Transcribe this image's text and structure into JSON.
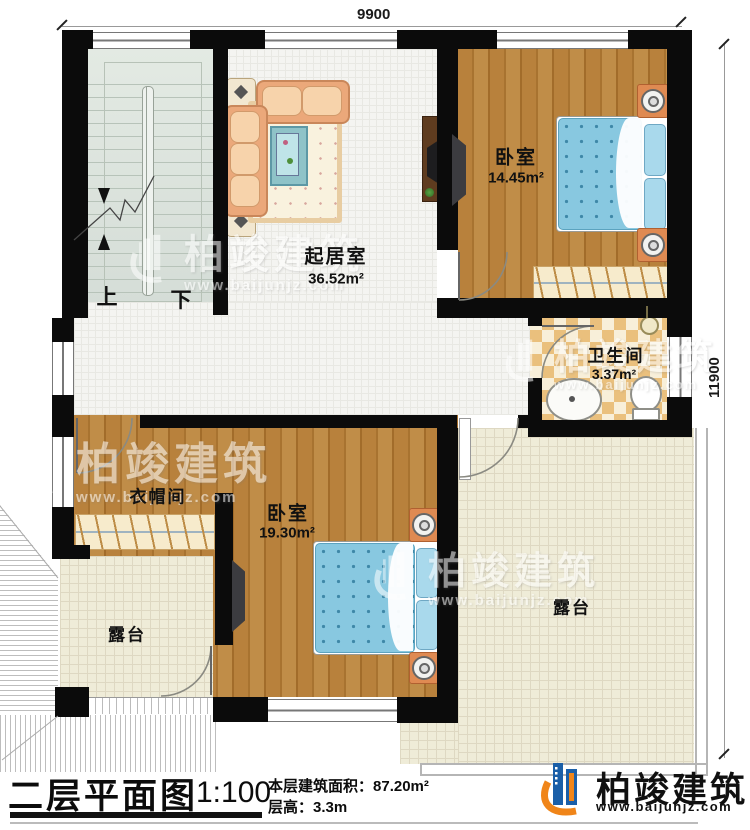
{
  "title_block": {
    "plan_title": "二层平面图",
    "scale": "1:100",
    "stats": [
      {
        "label": "本层建筑面积：",
        "value": "87.20m²"
      },
      {
        "label": "层高：",
        "value": "3.3m"
      }
    ]
  },
  "dimensions": {
    "top_width": "9900",
    "right_height": "11900"
  },
  "rooms": {
    "living": {
      "name": "起居室",
      "area": "36.52m²"
    },
    "bedroom_top": {
      "name": "卧室",
      "area": "14.45m²"
    },
    "bathroom": {
      "name": "卫生间",
      "area": "3.37m²"
    },
    "cloakroom": {
      "name": "衣帽间"
    },
    "bedroom_bottom": {
      "name": "卧室",
      "area": "19.30m²"
    },
    "terrace_left": {
      "name": "露台"
    },
    "terrace_right": {
      "name": "露台"
    }
  },
  "stairs": {
    "up": "上",
    "down": "下"
  },
  "branding": {
    "company": "柏竣建筑",
    "website": "www.baijunjz.com"
  },
  "colors": {
    "wall": "#0b0b0b",
    "wood_floor": "#b5813d",
    "bed_duvet": "#86c6de",
    "nightstand": "#df8a52",
    "bathroom_tile": "#eac07d",
    "terrace_tile": "#efecd8",
    "stair_floor": "#dee6df",
    "logo_blue": "#1b5fa8",
    "logo_orange": "#f08519"
  }
}
